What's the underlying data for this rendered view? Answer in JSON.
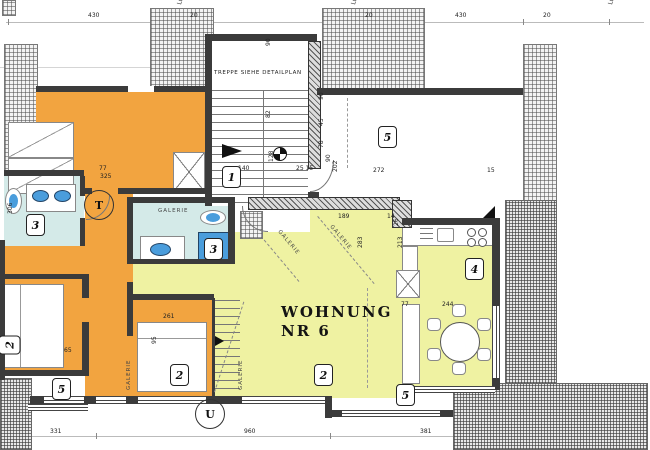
{
  "title": {
    "line1": "WOHNUNG",
    "line2": "NR 6"
  },
  "notes": {
    "stair": "TREPPE SIEHE DETAILPLAN"
  },
  "colors": {
    "orange": "#F2A440",
    "yellow": "#EFF2A2",
    "cyan": "#D4EAE8",
    "fixture_blue": "#4A9DDC",
    "wall": "#3B3B3B"
  },
  "overlays": {
    "dims": [
      {
        "x": 88,
        "y": 13,
        "t": "430"
      },
      {
        "x": 190,
        "y": 13,
        "t": "20"
      },
      {
        "x": 365,
        "y": 13,
        "t": "20"
      },
      {
        "x": 455,
        "y": 13,
        "t": "430"
      },
      {
        "x": 543,
        "y": 13,
        "t": "20"
      },
      {
        "x": 177,
        "y": 4,
        "t": "Lü 20",
        "r": -75
      },
      {
        "x": 351,
        "y": 4,
        "t": "Lü 20",
        "r": -75
      },
      {
        "x": 608,
        "y": 4,
        "t": "Lü 20",
        "r": -75
      },
      {
        "x": 50,
        "y": 429,
        "t": "331"
      },
      {
        "x": 244,
        "y": 429,
        "t": "960"
      },
      {
        "x": 420,
        "y": 429,
        "t": "381"
      },
      {
        "x": 266,
        "y": 46,
        "t": "90",
        "r": -90
      },
      {
        "x": 266,
        "y": 118,
        "t": "82",
        "r": -90
      },
      {
        "x": 238,
        "y": 166,
        "t": "140"
      },
      {
        "x": 269,
        "y": 162,
        "t": "128",
        "r": -90
      },
      {
        "x": 296,
        "y": 166,
        "t": "25  15"
      },
      {
        "x": 326,
        "y": 162,
        "t": "90",
        "r": -90
      },
      {
        "x": 333,
        "y": 172,
        "t": "202",
        "r": -90
      },
      {
        "x": 373,
        "y": 168,
        "t": "272"
      },
      {
        "x": 487,
        "y": 168,
        "t": "15"
      },
      {
        "x": 319,
        "y": 100,
        "t": "90",
        "r": -90
      },
      {
        "x": 319,
        "y": 126,
        "t": "45",
        "r": -90
      },
      {
        "x": 319,
        "y": 148,
        "t": "78",
        "r": -90
      },
      {
        "x": 99,
        "y": 166,
        "t": "77"
      },
      {
        "x": 100,
        "y": 174,
        "t": "325"
      },
      {
        "x": 8,
        "y": 214,
        "t": "306",
        "r": -90
      },
      {
        "x": 394,
        "y": 226,
        "t": "26",
        "r": -90
      },
      {
        "x": 398,
        "y": 248,
        "t": "213",
        "r": -90
      },
      {
        "x": 401,
        "y": 302,
        "t": "77"
      },
      {
        "x": 442,
        "y": 302,
        "t": "244"
      },
      {
        "x": 338,
        "y": 214,
        "t": "189"
      },
      {
        "x": 387,
        "y": 214,
        "t": "14"
      },
      {
        "x": 358,
        "y": 248,
        "t": "283",
        "r": -90
      },
      {
        "x": 163,
        "y": 314,
        "t": "261"
      },
      {
        "x": 152,
        "y": 344,
        "t": "95",
        "r": -90
      },
      {
        "x": 64,
        "y": 348,
        "t": "65"
      }
    ],
    "tags": [
      {
        "x": 222,
        "y": 166,
        "t": "1"
      },
      {
        "x": 170,
        "y": 364,
        "t": "2"
      },
      {
        "x": 314,
        "y": 364,
        "t": "2"
      },
      {
        "x": 0,
        "y": 334,
        "t": "2",
        "r": -90
      },
      {
        "x": 26,
        "y": 214,
        "t": "3"
      },
      {
        "x": 204,
        "y": 238,
        "t": "3"
      },
      {
        "x": 465,
        "y": 258,
        "t": "4"
      },
      {
        "x": 378,
        "y": 126,
        "t": "5"
      },
      {
        "x": 52,
        "y": 378,
        "t": "5"
      },
      {
        "x": 396,
        "y": 384,
        "t": "5"
      }
    ],
    "galerie": [
      {
        "x": 158,
        "y": 208,
        "t": "GALERIE",
        "r": 0
      },
      {
        "x": 281,
        "y": 229,
        "t": "GALERIE",
        "r": 50
      },
      {
        "x": 333,
        "y": 224,
        "t": "GALERIE",
        "r": 50
      },
      {
        "x": 126,
        "y": 390,
        "t": "GALERIE",
        "r": -90
      },
      {
        "x": 238,
        "y": 390,
        "t": "GALERIE",
        "r": -90
      }
    ],
    "markers": [
      {
        "x": 84,
        "y": 190,
        "t": "T"
      },
      {
        "x": 195,
        "y": 399,
        "t": "U"
      }
    ]
  }
}
